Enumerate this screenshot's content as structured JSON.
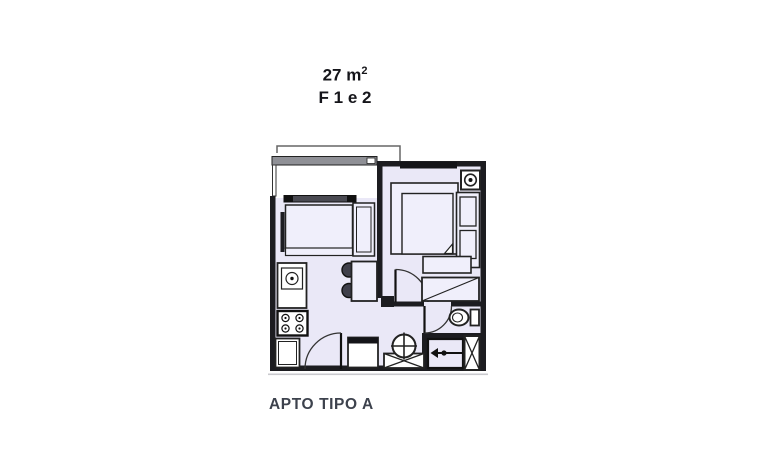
{
  "title": {
    "area": "27 m",
    "area_exponent": "2",
    "unit_line": "F 1 e 2"
  },
  "caption": "APTO TIPO A",
  "colors": {
    "wall": "#1c1c20",
    "floor": "#eae8f7",
    "floor2": "#f0effb",
    "fixture": "#ffffff",
    "railing": "#8f9096",
    "window": "#141418",
    "line": "#333333",
    "text": "#15151a",
    "caption": "#3d424d",
    "shadow": "#c9c9ce"
  },
  "floorplan": {
    "fixtures": [
      "balcony-railing",
      "living-window",
      "bedroom-window",
      "sofa",
      "dining-table",
      "dining-chairs",
      "kitchen-sink",
      "stove",
      "kitchen-cabinet",
      "kitchen-door",
      "bed",
      "bed-bench",
      "nightstand-shelves",
      "ceiling-spot",
      "bedroom-door",
      "closet",
      "bathroom-door",
      "toilet",
      "washer",
      "laundry-basin",
      "entrance-hall",
      "entrance-arrow",
      "entry-door"
    ]
  }
}
